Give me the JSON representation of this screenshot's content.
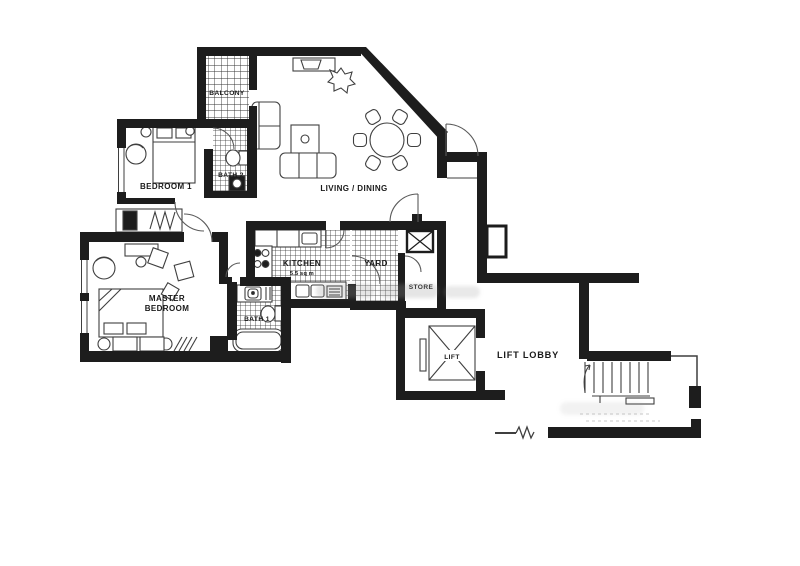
{
  "canvas": {
    "width": 800,
    "height": 566,
    "background": "#ffffff"
  },
  "colors": {
    "wall": "#1d1d1d",
    "furniture_line": "#3f3f3f",
    "door_arc": "#5a5a5a",
    "hatch": "#333333",
    "label": "#1a1a1a",
    "watermark": "#9a9a9a"
  },
  "labels": {
    "balcony": "BALCONY",
    "bedroom1": "BEDROOM 1",
    "bath2": "BATH 2",
    "living_dining": "LIVING / DINING",
    "kitchen": "KITCHEN",
    "kitchen_area": "5.5 sq m",
    "yard": "YARD",
    "store": "STORE",
    "master_line1": "MASTER",
    "master_line2": "BEDROOM",
    "bath1": "BATH 1",
    "lift": "LIFT",
    "lift_lobby": "LIFT LOBBY"
  }
}
